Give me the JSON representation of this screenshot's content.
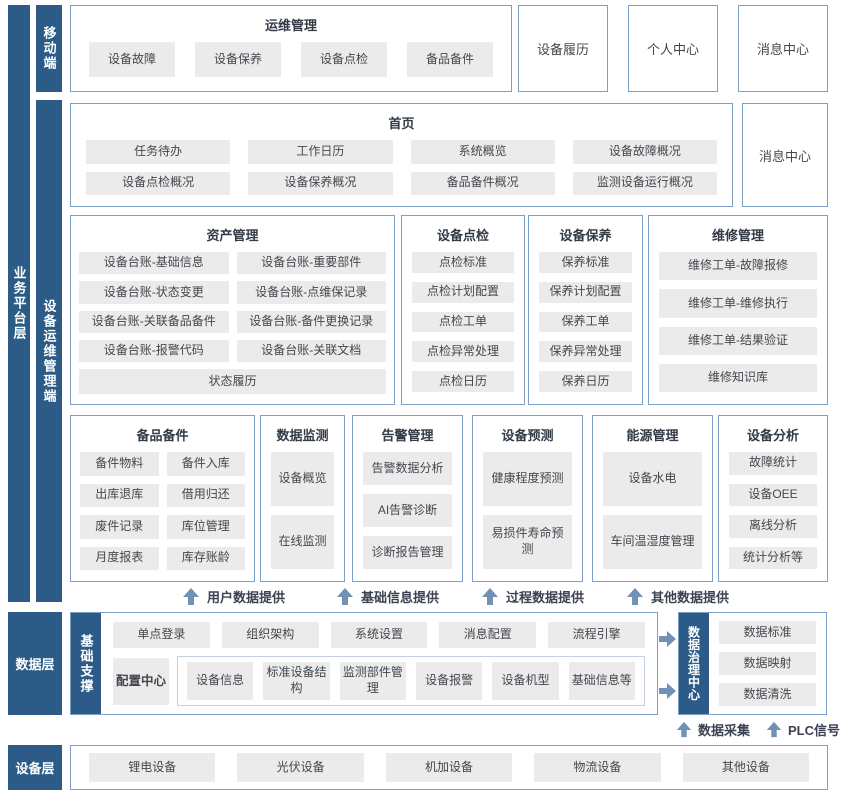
{
  "colors": {
    "layer_bar": "#2b5b86",
    "box_border": "#7b9fc5",
    "item_background": "#ebebeb",
    "arrow": "#7191b7"
  },
  "left_bars": {
    "business": "业务平台层",
    "mobile": "移动端",
    "device_ops": "设备运维管理端",
    "data_layer": "数据层",
    "device_layer": "设备层"
  },
  "mobile_row": {
    "ops": {
      "title": "运维管理",
      "items": [
        "设备故障",
        "设备保养",
        "设备点检",
        "备品备件"
      ]
    },
    "boxes": [
      "设备履历",
      "个人中心",
      "消息中心"
    ]
  },
  "home_row": {
    "title": "首页",
    "items": [
      "任务待办",
      "工作日历",
      "系统概览",
      "设备故障概况",
      "设备点检概况",
      "设备保养概况",
      "备品备件概况",
      "监测设备运行概况"
    ],
    "message_center": "消息中心"
  },
  "sections_row3": {
    "asset": {
      "title": "资产管理",
      "items": [
        "设备台账-基础信息",
        "设备台账-重要部件",
        "设备台账-状态变更",
        "设备台账-点维保记录",
        "设备台账-关联备品备件",
        "设备台账-备件更换记录",
        "设备台账-报警代码",
        "设备台账-关联文档"
      ],
      "full_item": "状态履历"
    },
    "inspection": {
      "title": "设备点检",
      "items": [
        "点检标准",
        "点检计划配置",
        "点检工单",
        "点检异常处理",
        "点检日历"
      ]
    },
    "maintenance": {
      "title": "设备保养",
      "items": [
        "保养标准",
        "保养计划配置",
        "保养工单",
        "保养异常处理",
        "保养日历"
      ]
    },
    "repair": {
      "title": "维修管理",
      "items": [
        "维修工单-故障报修",
        "维修工单-维修执行",
        "维修工单-结果验证",
        "维修知识库"
      ]
    }
  },
  "sections_row4": {
    "spare_parts": {
      "title": "备品备件",
      "items": [
        "备件物料",
        "备件入库",
        "出库退库",
        "借用归还",
        "废件记录",
        "库位管理",
        "月度报表",
        "库存账龄"
      ]
    },
    "data_monitor": {
      "title": "数据监测",
      "items": [
        "设备概览",
        "在线监测"
      ]
    },
    "alarm": {
      "title": "告警管理",
      "items": [
        "告警数据分析",
        "AI告警诊断",
        "诊断报告管理"
      ]
    },
    "prediction": {
      "title": "设备预测",
      "items": [
        "健康程度预测",
        "易损件寿命预测"
      ]
    },
    "energy": {
      "title": "能源管理",
      "items": [
        "设备水电",
        "车间温湿度管理"
      ]
    },
    "analysis": {
      "title": "设备分析",
      "items": [
        "故障统计",
        "设备OEE",
        "离线分析",
        "统计分析等"
      ]
    }
  },
  "flow_labels": [
    "用户数据提供",
    "基础信息提供",
    "过程数据提供",
    "其他数据提供"
  ],
  "data_row": {
    "support_label": "基础支撑",
    "top_items": [
      "单点登录",
      "组织架构",
      "系统设置",
      "消息配置",
      "流程引擎"
    ],
    "config_center": "配置中心",
    "bottom_items": [
      "设备信息",
      "标准设备结构",
      "监测部件管理",
      "设备报警",
      "设备机型",
      "基础信息等"
    ],
    "governance": {
      "label": "数据治理中心",
      "items": [
        "数据标准",
        "数据映射",
        "数据清洗"
      ]
    },
    "collect_labels": [
      "数据采集",
      "PLC信号"
    ]
  },
  "device_row": {
    "items": [
      "锂电设备",
      "光伏设备",
      "机加设备",
      "物流设备",
      "其他设备"
    ]
  }
}
